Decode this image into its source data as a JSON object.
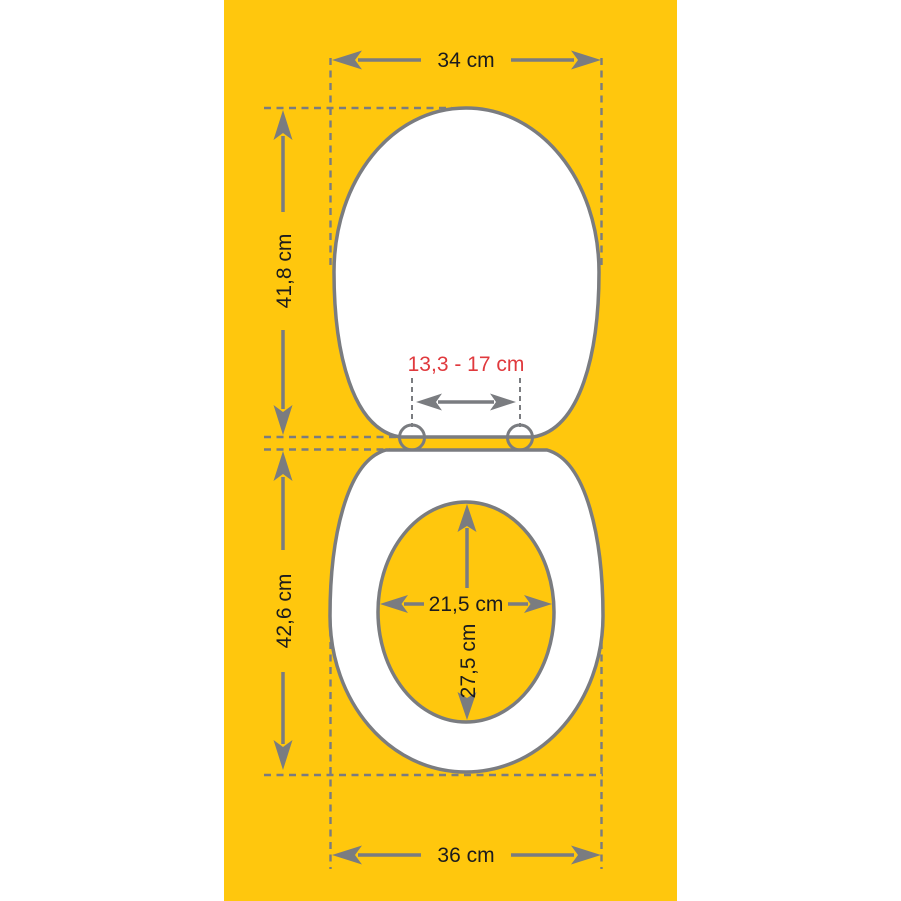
{
  "colors": {
    "background": "#ffffff",
    "canvas": "#ffc70d",
    "line": "#7a7c80",
    "text": "#1c1c1e",
    "accent": "#e0393d"
  },
  "diagram": {
    "lid": {
      "width_label": "34 cm",
      "height_label": "41,8 cm",
      "hinge_spacing_label": "13,3 - 17 cm"
    },
    "seat": {
      "length_label": "42,6 cm",
      "width_label": "36 cm",
      "hole_width_label": "21,5 cm",
      "hole_depth_label": "27,5 cm"
    }
  }
}
